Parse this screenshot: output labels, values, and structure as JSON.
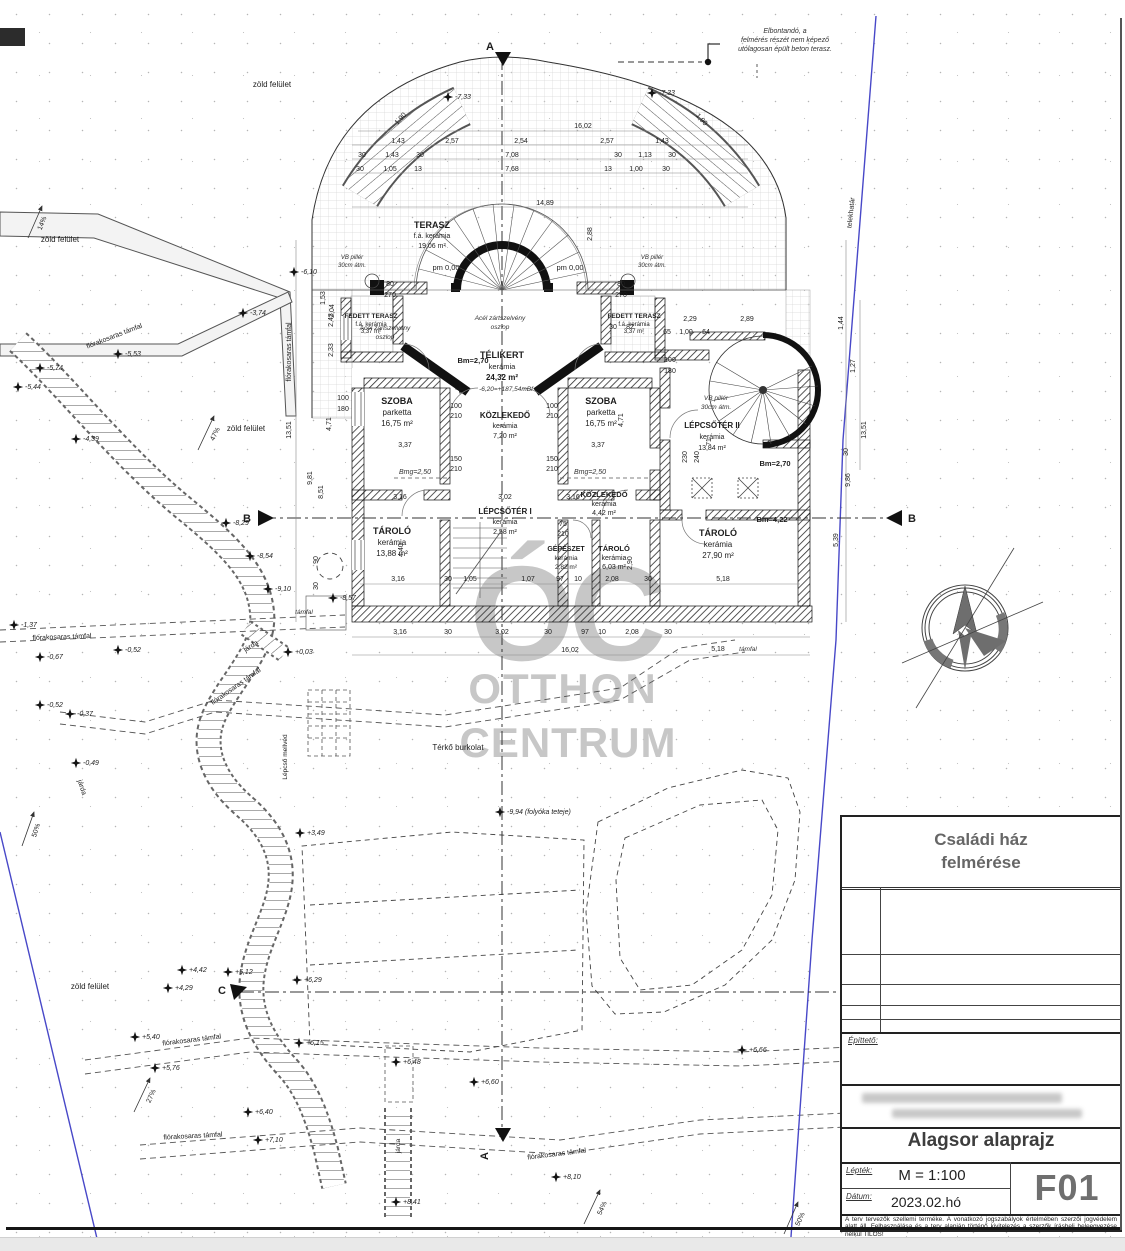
{
  "watermark": {
    "logo": "ÓC",
    "line1": "OTTHON",
    "line2": "CENTRUM"
  },
  "title_block": {
    "project_title_line1": "Családi ház",
    "project_title_line2": "felmérése",
    "client_label": "Építtető:",
    "drawing_title": "Alagsor alaprajz",
    "scale_label": "Lépték:",
    "scale_value": "M = 1:100",
    "date_label": "Dátum:",
    "date_value": "2023.02.hó",
    "drawing_number": "F01",
    "disclaimer": "A terv tervezők szellemi terméke. A vonatkozó jogszabályok értelmében szerzői jogvédelem alatt áll. Felhasználása és a terv alapján történő kivitelezés a szerzők írásbeli beleegyezése nélkül TILOS!"
  },
  "notes": {
    "demolish1": "Elbontandó, a",
    "demolish2": "felmérés részét nem képező",
    "demolish3": "utólagosan épült beton terasz.",
    "steel1": "Acél zártszelvény",
    "steel2": "oszlop",
    "vb1": "VB pillér",
    "vb2": "30cm átm.",
    "pm": "pm 0,00",
    "level_ref": "-6,20=+187,54mBf",
    "folyoka": "-9,94 (folyóka teteje)"
  },
  "rooms": {
    "terasz": {
      "name": "TERASZ",
      "finish": "f.á. kerámia",
      "area": "19,06 m²"
    },
    "telikert": {
      "name": "TÉLIKERT",
      "finish": "kerámia",
      "area": "24,32 m²"
    },
    "fedett": {
      "name": "FEDETT TERASZ",
      "finish": "f.á. kerámia",
      "area": "3,37 m²"
    },
    "szoba": {
      "name": "SZOBA",
      "finish": "parketta",
      "area": "16,75 m²"
    },
    "kozlekedo1": {
      "name": "KÖZLEKEDŐ",
      "finish": "kerámia",
      "area": "7,20 m²"
    },
    "lepcsoter2": {
      "name": "LÉPCSŐTÉR II",
      "finish": "kerámia",
      "area": "13,84 m²"
    },
    "kozlekedo2": {
      "name": "KÖZLEKEDŐ",
      "finish": "kerámia",
      "area": "4,42 m²"
    },
    "lepcsoter1": {
      "name": "LÉPCSŐTÉR I",
      "finish": "kerámia",
      "area": "2,58 m²"
    },
    "tarolo1": {
      "name": "TÁROLÓ",
      "finish": "kerámia",
      "area": "13,88 m²"
    },
    "gepeszet": {
      "name": "GÉPÉSZET",
      "finish": "kerámia",
      "area": "2,82 m²"
    },
    "tarolo2": {
      "name": "TÁROLÓ",
      "finish": "kerámia",
      "area": "6,03 m²"
    },
    "tarolo3": {
      "name": "TÁROLÓ",
      "finish": "kerámia",
      "area": "27,90 m²"
    }
  },
  "heights": {
    "bm270": "Bm=2,70",
    "bm422": "Bm=4,22",
    "bmg250": "Bmg=2,50"
  },
  "site": {
    "zold": "zöld felület",
    "flora": "flórakosaras támfal",
    "tamfal": "támfal",
    "terko": "Térkő burkolat",
    "jarda": "járda",
    "mellved": "Lépcső mellvéd",
    "telekhatar": "telekhatár"
  },
  "slopes": {
    "p14": "14%",
    "p47": "47%",
    "p50": "50%",
    "p27": "27%",
    "p54": "54%"
  },
  "levels": [
    "-7,33",
    "-7,33",
    "-6,10",
    "-3,74",
    "-5,53",
    "-5,74",
    "-5,44",
    "-4,39",
    "-8,29",
    "-8,54",
    "-9,10",
    "-8,57",
    "-1,37",
    "-0,67",
    "-0,52",
    "-0,52",
    "-0,37",
    "-0,49",
    "+0,03",
    "+3,49",
    "+5,40",
    "+5,76",
    "+4,29",
    "+4,42",
    "+5,12",
    "+6,29",
    "+6,15",
    "+6,40",
    "+7,10",
    "+6,48",
    "+6,60",
    "+8,10",
    "+8,41",
    "+6,66"
  ],
  "sections": {
    "a": "A",
    "b": "B",
    "c": "C"
  },
  "dims": {
    "top_total": "16,02",
    "row2": [
      "1,43",
      "2,57",
      "2,54",
      "2,57",
      "1,43"
    ],
    "row3": [
      "30",
      "1,43",
      "30",
      "7,08",
      "30",
      "1,13",
      "30"
    ],
    "row4": [
      "30",
      "1,05",
      "13",
      "7,68",
      "13",
      "1,00",
      "30"
    ],
    "overall": "14,89",
    "inner_bottom": [
      "3,16",
      "30",
      "1,05",
      "1,07",
      "97",
      "10",
      "2,08",
      "30"
    ],
    "outer_bottom": [
      "3,16",
      "30",
      "3,02",
      "30",
      "97",
      "10",
      "2,08",
      "30"
    ],
    "bottom_total": "16,02",
    "left_col": [
      "13,51",
      "9,81",
      "8,51",
      "90",
      "2,43",
      "2,33",
      "1,53",
      "30"
    ],
    "right_col": [
      "13,51",
      "9,86",
      "5,39",
      "1,44",
      "1,27",
      "30"
    ],
    "misc": [
      "3,37",
      "3,37",
      "150",
      "210",
      "150",
      "210",
      "100",
      "210",
      "100",
      "210",
      "100",
      "180",
      "100",
      "180",
      "80",
      "270",
      "80",
      "270",
      "4,40",
      "2,90",
      "5,18",
      "5,18",
      "2,29",
      "2,89",
      "1,00",
      "64",
      "65",
      "82",
      "30",
      "230",
      "240",
      "71",
      "75",
      "210",
      "4,71",
      "4,71",
      "3,16",
      "3,02",
      "3,16",
      "2,88",
      "2,04",
      "1,90",
      "1,90"
    ]
  }
}
